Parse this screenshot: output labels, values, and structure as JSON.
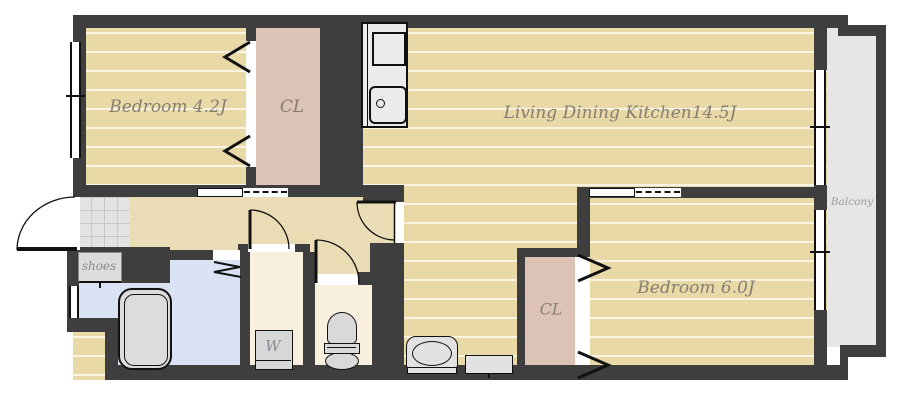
{
  "title": "2LDK apartment floor plan",
  "labels": {
    "bedroom1": "Bedroom 4.2J",
    "closet1": "CL",
    "ldk": "Living Dining Kitchen14.5J",
    "balcony": "Balcony",
    "bedroom2": "Bedroom 6.0J",
    "closet2": "CL",
    "shoes": "shoes",
    "washer": "W"
  },
  "colors": {
    "wall": "#3e3e3e",
    "room_floor": "#e9d9a7",
    "floor_stripe": "#faf5e2",
    "hallway_floor": "#eaddb6",
    "closet_floor": "#dcc3b6",
    "bathroom_floor": "#d9e3f3",
    "service_floor": "#f9efdf",
    "balcony_floor": "#e6e6e8",
    "tile": "#e3e3e3",
    "fixture_fill": "#dcdcdc",
    "label_text": "#857f72"
  }
}
